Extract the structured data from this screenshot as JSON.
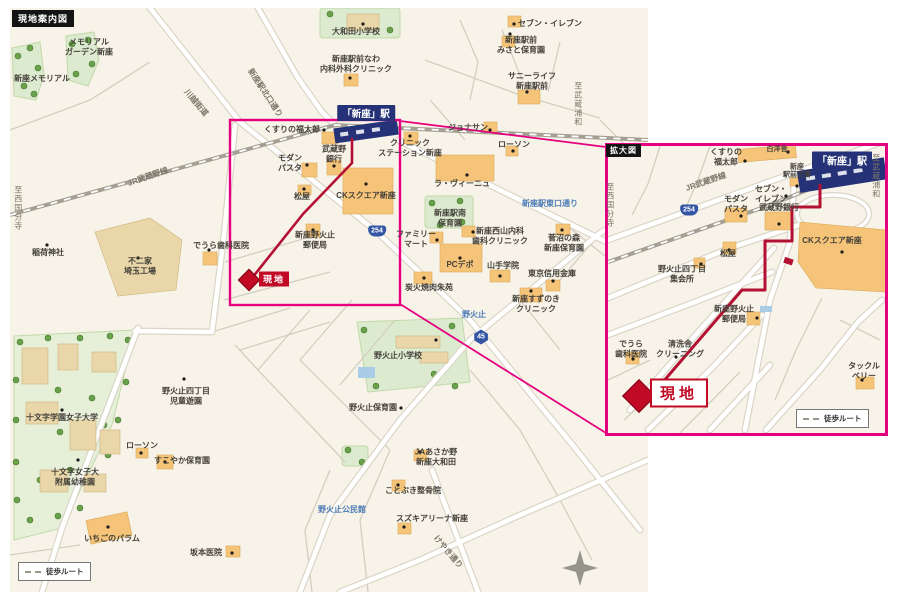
{
  "title": "現地案内図",
  "inset_title": "拡大図",
  "station": {
    "name": "「新座」駅"
  },
  "site": {
    "label": "現地"
  },
  "legend": {
    "walk_route": "徒歩ルート"
  },
  "colors": {
    "map_bg": "#f7f3e8",
    "building": "#f6c478",
    "station_navy": "#253277",
    "route_red": "#b41034",
    "magnifier_pink": "#e5007f",
    "site_red": "#c00a26",
    "label_blue": "#4a7ab5",
    "shield_blue": "#3355a4"
  },
  "main_map": {
    "labels": [
      {
        "t": "メモリアル\nガーデン新座",
        "x": 89,
        "y": 47
      },
      {
        "t": "新座メモリアル",
        "x": 42,
        "y": 79
      },
      {
        "t": "大和田小学校",
        "x": 356,
        "y": 32
      },
      {
        "t": "セブン・イレブン",
        "x": 550,
        "y": 24
      },
      {
        "t": "新座駅前\nみさと保育園",
        "x": 521,
        "y": 45
      },
      {
        "t": "新座駅前なわ\n内科外科クリニック",
        "x": 356,
        "y": 64
      },
      {
        "t": "サニーライフ\n新座駅前",
        "x": 532,
        "y": 81
      },
      {
        "t": "くすりの福太郎",
        "x": 292,
        "y": 130
      },
      {
        "t": "モダン\nパスタ",
        "x": 290,
        "y": 163
      },
      {
        "t": "武蔵野\n銀行",
        "x": 334,
        "y": 154
      },
      {
        "t": "クリニック\nステーション新座",
        "x": 410,
        "y": 148
      },
      {
        "t": "ジョナサン",
        "x": 468,
        "y": 128
      },
      {
        "t": "ローソン",
        "x": 514,
        "y": 145
      },
      {
        "t": "ラ・ヴィーニュ",
        "x": 462,
        "y": 184
      },
      {
        "t": "CKスクエア新座",
        "x": 366,
        "y": 196
      },
      {
        "t": "松屋",
        "x": 302,
        "y": 197
      },
      {
        "t": "新座野火止\n郵便局",
        "x": 315,
        "y": 240
      },
      {
        "t": "でうら歯科医院",
        "x": 221,
        "y": 246
      },
      {
        "t": "ファミリー\nマート",
        "x": 416,
        "y": 239
      },
      {
        "t": "新座駅南\n保育園",
        "x": 450,
        "y": 218
      },
      {
        "t": "新座西山内科\n歯科クリニック",
        "x": 500,
        "y": 236
      },
      {
        "t": "PCデポ",
        "x": 460,
        "y": 265
      },
      {
        "t": "山手学院",
        "x": 503,
        "y": 266
      },
      {
        "t": "菅沼の森\n新座保育園",
        "x": 564,
        "y": 243
      },
      {
        "t": "東京信用金庫",
        "x": 552,
        "y": 274
      },
      {
        "t": "新座すずのき\nクリニック",
        "x": 536,
        "y": 304
      },
      {
        "t": "炭火焼肉朱苑",
        "x": 429,
        "y": 288
      },
      {
        "t": "稲荷神社",
        "x": 48,
        "y": 253
      },
      {
        "t": "不二家\n埼玉工場",
        "x": 140,
        "y": 266
      },
      {
        "t": "野火止小学校",
        "x": 398,
        "y": 356
      },
      {
        "t": "野火止四丁目\n児童遊園",
        "x": 186,
        "y": 396
      },
      {
        "t": "野火止保育園",
        "x": 373,
        "y": 408
      },
      {
        "t": "JAあさか野\n新座大和田",
        "x": 436,
        "y": 457
      },
      {
        "t": "すこやか保育園",
        "x": 182,
        "y": 461
      },
      {
        "t": "ローソン",
        "x": 142,
        "y": 446
      },
      {
        "t": "十文字学園女子大学",
        "x": 62,
        "y": 418
      },
      {
        "t": "十文字女子大\n附属幼稚園",
        "x": 75,
        "y": 477
      },
      {
        "t": "いちごのパラム",
        "x": 112,
        "y": 539
      },
      {
        "t": "坂本医院",
        "x": 206,
        "y": 553
      },
      {
        "t": "ことぶき整骨院",
        "x": 413,
        "y": 491
      },
      {
        "t": "スズキアリーナ新座",
        "x": 432,
        "y": 519
      },
      {
        "t": "新座駅東口通り",
        "x": 550,
        "y": 204,
        "c": "blue"
      },
      {
        "t": "野火止",
        "x": 474,
        "y": 315,
        "c": "blue"
      },
      {
        "t": "野火止公民館",
        "x": 342,
        "y": 510,
        "c": "blue"
      },
      {
        "t": "川越街道",
        "x": 196,
        "y": 103,
        "c": "rd",
        "r": 50
      },
      {
        "t": "新座駅北口通り",
        "x": 265,
        "y": 93,
        "c": "rd",
        "r": 57
      },
      {
        "t": "JR武蔵野線",
        "x": 148,
        "y": 177,
        "c": "rd",
        "r": -19
      },
      {
        "t": "けやき通り",
        "x": 448,
        "y": 552,
        "c": "rd",
        "r": 50
      },
      {
        "t": "至西国分寺",
        "x": 18,
        "y": 208,
        "c": "vert"
      },
      {
        "t": "至武蔵浦和",
        "x": 578,
        "y": 104,
        "c": "vert"
      }
    ],
    "shields": [
      {
        "n": "254",
        "x": 377,
        "y": 231,
        "k": "nat"
      },
      {
        "n": "45",
        "x": 481,
        "y": 337,
        "k": "pref"
      }
    ]
  },
  "inset_map": {
    "labels": [
      {
        "t": "くすりの\n福太郎",
        "x": 726,
        "y": 157
      },
      {
        "t": "白洋舎",
        "x": 777,
        "y": 150,
        "c": "sm"
      },
      {
        "t": "新座\n駅前交番",
        "x": 797,
        "y": 172,
        "c": "sm"
      },
      {
        "t": "セブン・\nイレブン",
        "x": 771,
        "y": 194
      },
      {
        "t": "モダン\nパスタ",
        "x": 736,
        "y": 204
      },
      {
        "t": "武蔵野銀行",
        "x": 779,
        "y": 208
      },
      {
        "t": "CKスクエア新座",
        "x": 832,
        "y": 241
      },
      {
        "t": "松屋",
        "x": 728,
        "y": 254
      },
      {
        "t": "野火止四丁目\n集会所",
        "x": 682,
        "y": 274
      },
      {
        "t": "新座野火止\n郵便局",
        "x": 734,
        "y": 314
      },
      {
        "t": "でうら\n歯科医院",
        "x": 631,
        "y": 349
      },
      {
        "t": "清洗舎\nクリーニング",
        "x": 680,
        "y": 349
      },
      {
        "t": "タックル\nベリー",
        "x": 864,
        "y": 371
      },
      {
        "t": "JR武蔵野線",
        "x": 706,
        "y": 182,
        "c": "rd",
        "r": -19
      },
      {
        "t": "至西国分寺",
        "x": 610,
        "y": 205,
        "c": "vert"
      },
      {
        "t": "至武蔵浦和",
        "x": 876,
        "y": 176,
        "c": "vert"
      }
    ],
    "shields": [
      {
        "n": "254",
        "x": 689,
        "y": 210,
        "k": "nat"
      }
    ]
  }
}
